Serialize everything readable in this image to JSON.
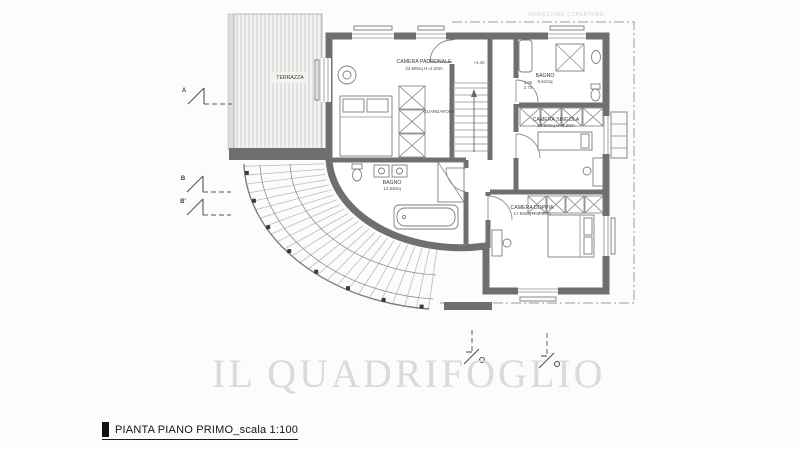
{
  "title_block": {
    "caption": "PIANTA PIANO PRIMO_scala 1:100"
  },
  "watermark": "IL QUADRIFOGLIO",
  "annotations": {
    "roof_projection": "PROIEZIONE COPERTURA",
    "level_mark": "+4.40",
    "door_dim_top": "2.86",
    "door_dim_bottom": "2.70"
  },
  "rooms": {
    "camera_padronale": {
      "name": "CAMERA PADRONALE",
      "area": "24.68mq H=2.20m"
    },
    "bagno_nord": {
      "name": "BAGNO",
      "area": "9.61mq"
    },
    "camera_singola": {
      "name": "CAMERA SINGOLA",
      "area": "12.90mq H=2.20m"
    },
    "camera_doppia": {
      "name": "CAMERA DOPPIA",
      "area": "17.93mq H=2.20m"
    },
    "bagno_sud": {
      "name": "BAGNO",
      "area": "12.63mq"
    },
    "guardaroba": {
      "name": "GUARDAROBA"
    },
    "terrazza": {
      "name": "TERRAZZA"
    }
  },
  "section_markers": {
    "a": "A",
    "b": "B",
    "b_prime": "B'"
  }
}
